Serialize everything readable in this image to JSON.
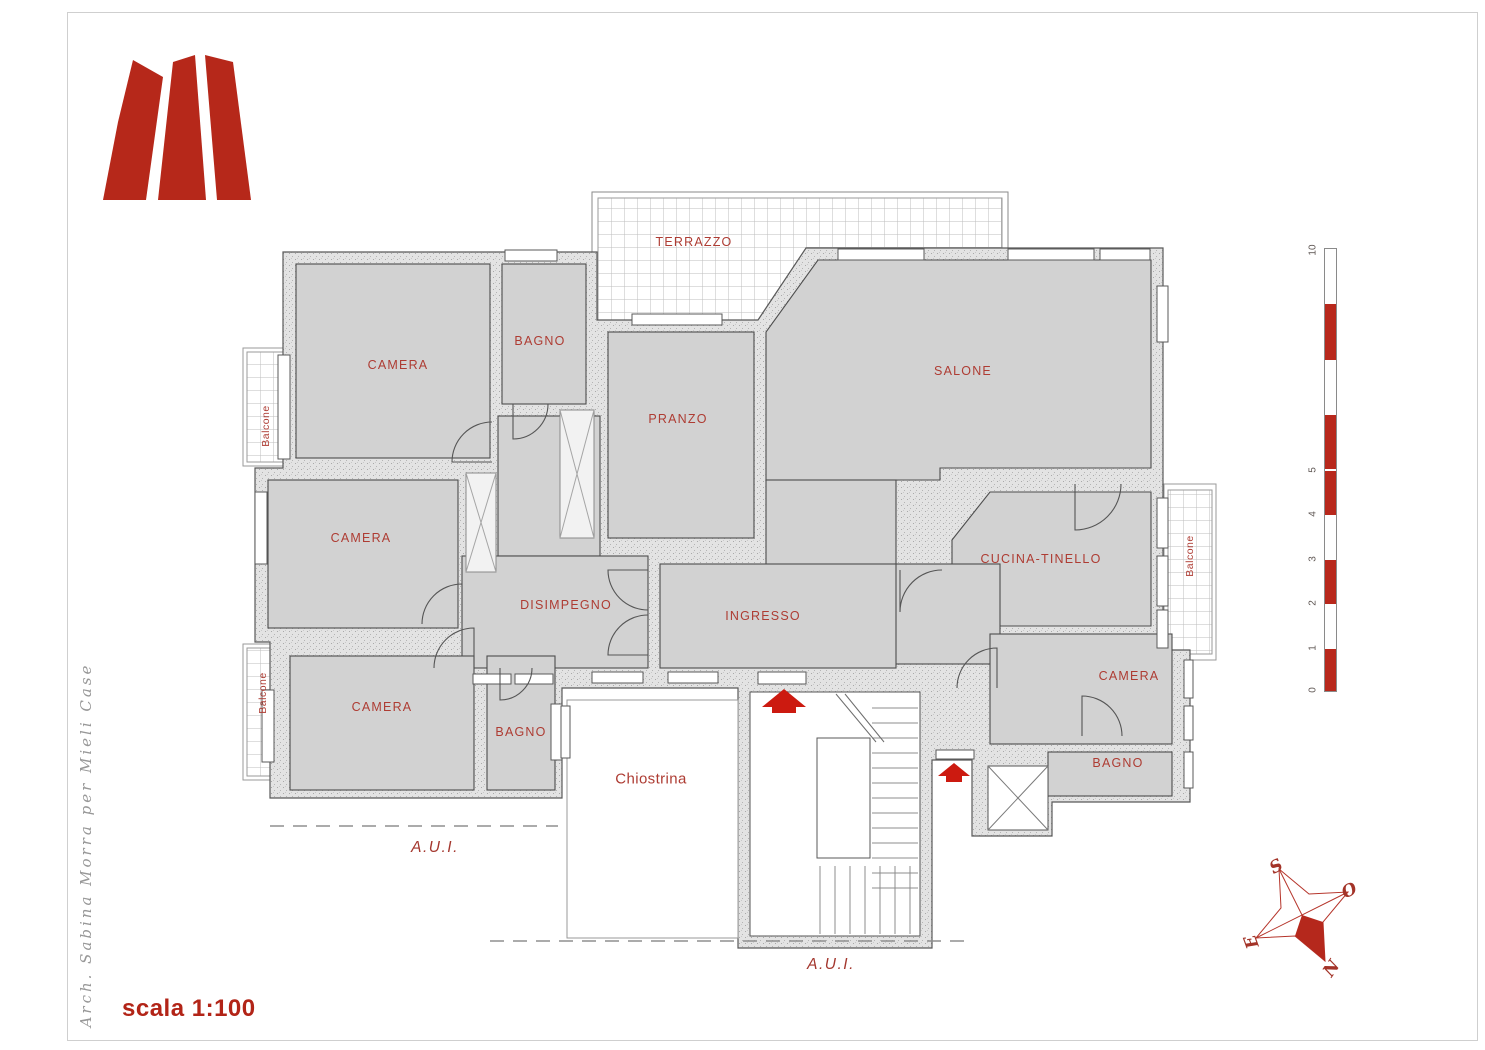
{
  "branding": {
    "logo_letter": "M",
    "credit": "Arch. Sabina Morra per Mieli Case"
  },
  "title_block": {
    "scale_label": "scala 1:100"
  },
  "rooms": {
    "camera_tl": "CAMERA",
    "bagno_top": "BAGNO",
    "pranzo": "PRANZO",
    "salone": "SALONE",
    "camera_mid": "CAMERA",
    "cucina_tinello": "CUCINA-TINELLO",
    "disimpegno": "DISIMPEGNO",
    "ingresso": "INGRESSO",
    "camera_bl": "CAMERA",
    "bagno_bl": "BAGNO",
    "camera_br": "CAMERA",
    "bagno_br": "BAGNO"
  },
  "outdoor": {
    "terrazzo": "TERRAZZO",
    "chiostrina": "Chiostrina",
    "balcone": "Balcone",
    "aui": "A.U.I."
  },
  "scale_bar": {
    "unit_labels": [
      "10",
      "5",
      "4",
      "3",
      "2",
      "1",
      "0"
    ]
  },
  "compass": {
    "s": "S",
    "o": "O",
    "e": "E",
    "n": "N"
  },
  "colors": {
    "logo_red": "#b6281a",
    "label_red": "#ae3c33",
    "arrow_red": "#cc1a10",
    "scalebar_red": "#b8281c",
    "room_fill": "#d2d2d2",
    "wall_fill": "#e3e3e3"
  }
}
